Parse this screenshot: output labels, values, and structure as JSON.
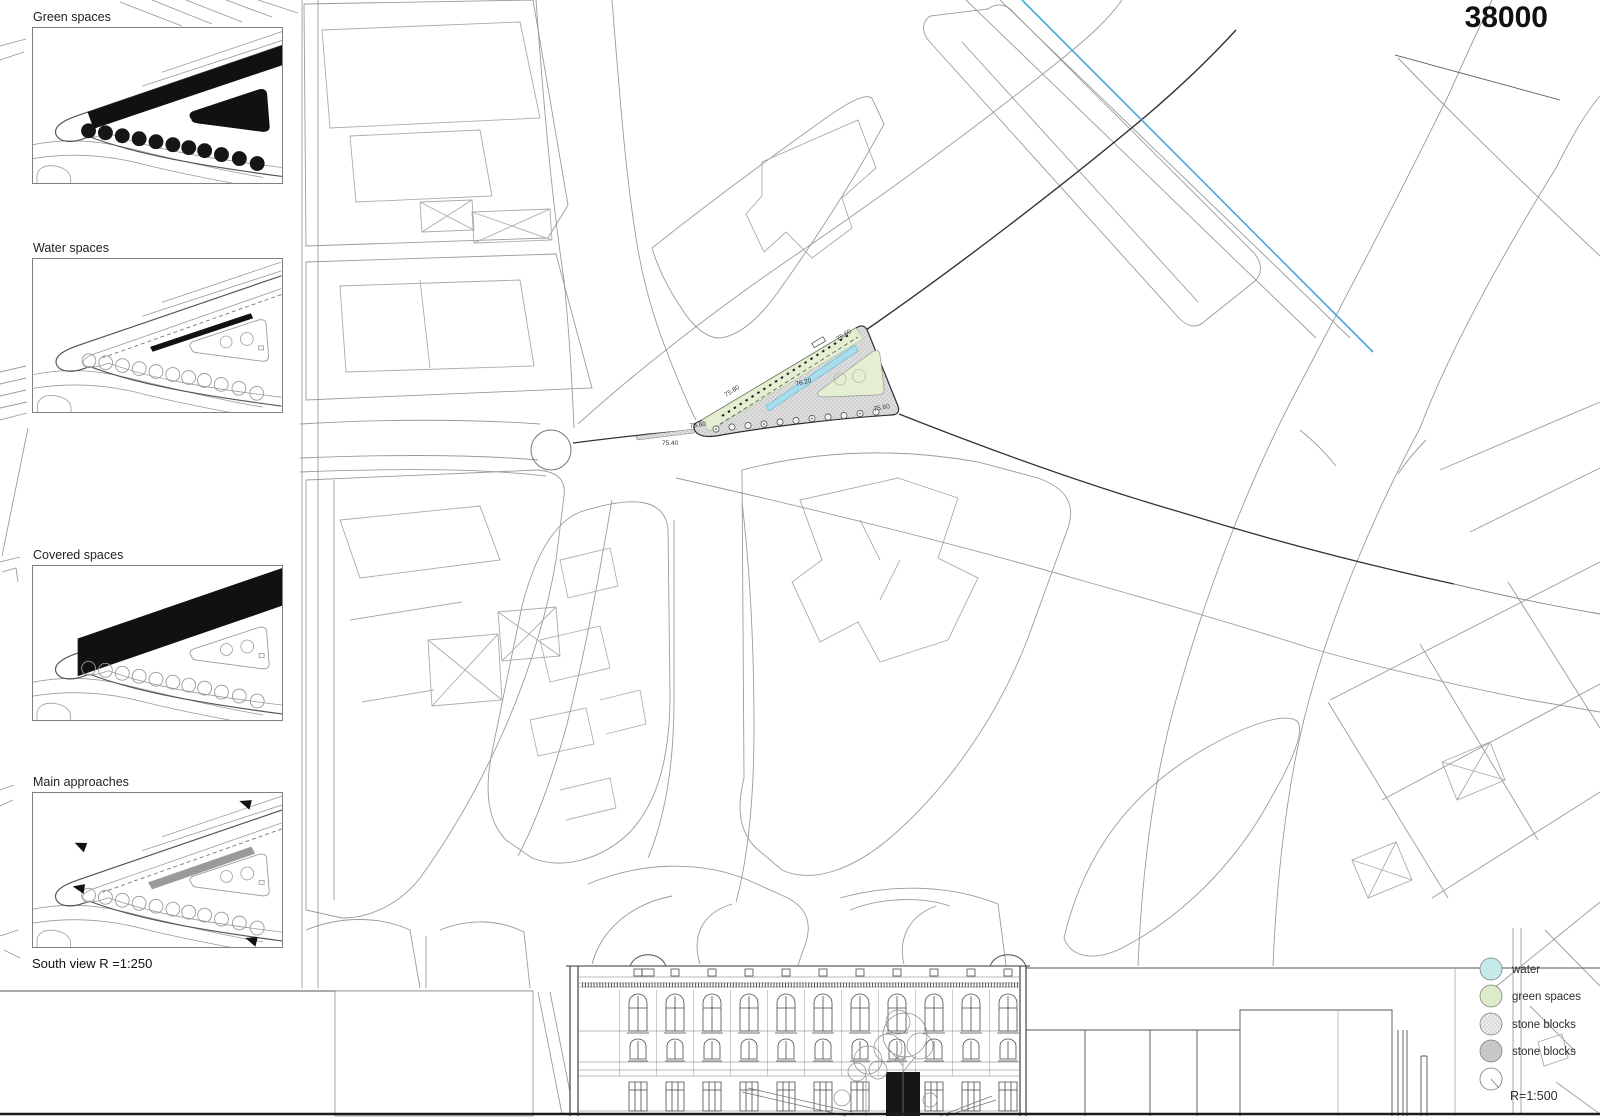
{
  "sheet": {
    "number": "38000"
  },
  "sidebar": {
    "diagrams": [
      {
        "label": "Green spaces"
      },
      {
        "label": "Water spaces"
      },
      {
        "label": "Covered spaces"
      },
      {
        "label": "Main approaches"
      }
    ],
    "south_view_caption": "South view R =1:250"
  },
  "plan": {
    "elevations": {
      "tip": "75.60",
      "road": "75.40",
      "mid": "75.80",
      "center": "76.20",
      "apex": "75.60",
      "corner": "75.60"
    },
    "colors": {
      "river": "#45a8dc",
      "water": "#aadcec",
      "green": "#e4efd2",
      "stone_light": "#dedede",
      "stone_dark": "#c8c8c8"
    }
  },
  "legend": {
    "items": [
      {
        "label": "water",
        "color": "#c6e9e9"
      },
      {
        "label": "green spaces",
        "color": "#dcecc8"
      },
      {
        "label": "stone blocks",
        "color": "#ececec"
      },
      {
        "label": "stone blocks",
        "color": "#c8c8c8"
      }
    ],
    "scale": "R=1:500"
  }
}
